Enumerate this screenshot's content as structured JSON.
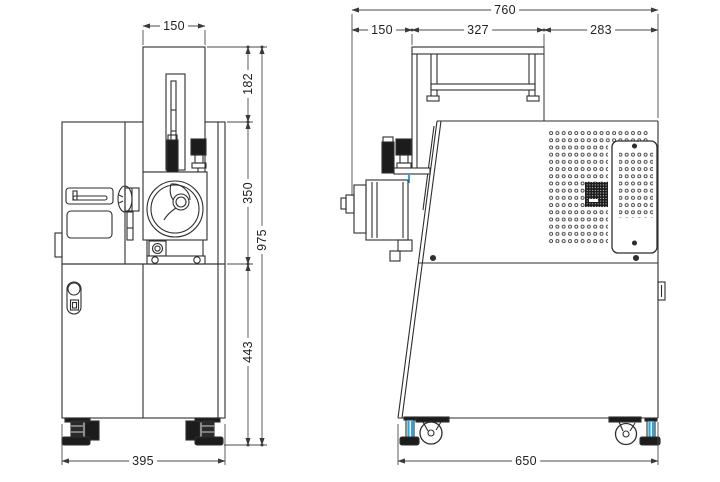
{
  "drawing": {
    "type": "technical-dimension-drawing",
    "views": {
      "front": {
        "name": "front view",
        "dims": {
          "top_width": "150",
          "upper_height": "182",
          "mid_height": "350",
          "lower_height": "443",
          "total_height": "975",
          "base_width": "395"
        }
      },
      "side": {
        "name": "side view",
        "dims": {
          "total_depth": "760",
          "front_depth": "150",
          "mid_depth": "327",
          "rear_depth": "283",
          "base_depth": "650"
        }
      }
    },
    "colors": {
      "background": "#ffffff",
      "machine_line": "#2e2e2e",
      "dimension_line": "#4a4a4a",
      "accent_blue": "#2ba7df",
      "dark_fill": "#1c1c1c"
    }
  }
}
